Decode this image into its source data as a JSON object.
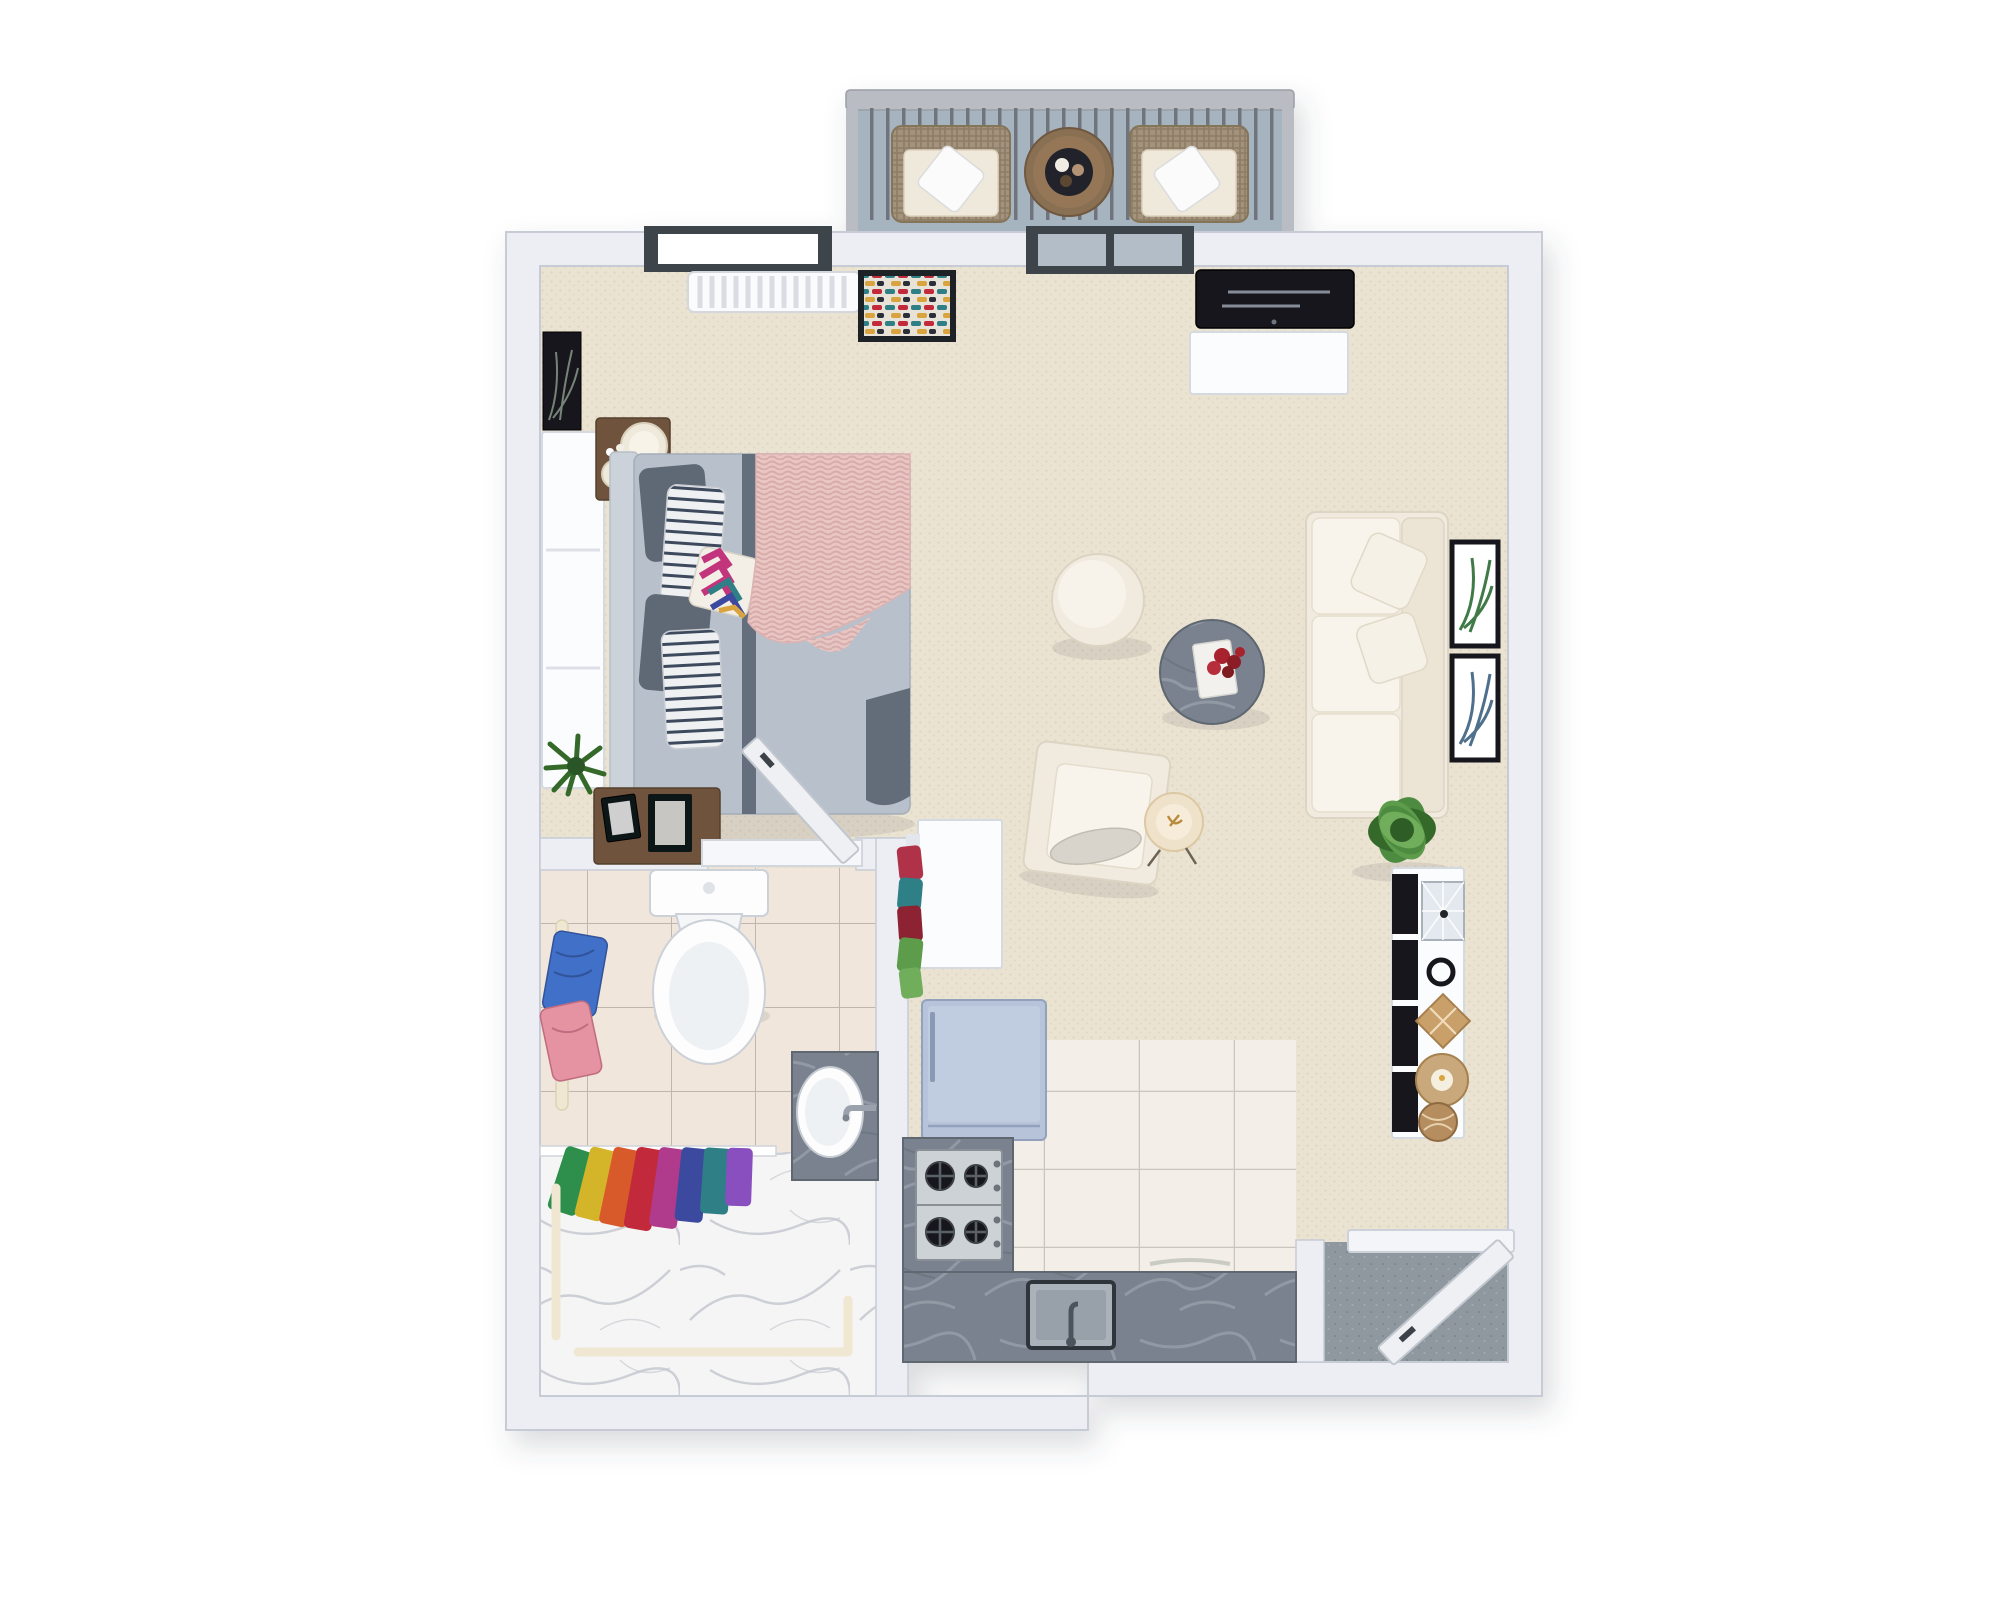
{
  "scene": {
    "title": "3D top-down floor plan of a studio apartment",
    "subtitle": "One-room apartment with balcony, open living/bedroom, bathroom and kitchen",
    "view": "axonometric top-down 3D render on white background"
  },
  "palette": {
    "wall-fill": "#eceef4",
    "wall-edge": "#c7cbd5",
    "floor-carpet": "#ebe3d2",
    "carpet-dot": "#ded3bd",
    "bath-tile": "#f0e6dc",
    "tile-grout": "#97908a",
    "kitchen-tile": "#f3efe8",
    "kitchen-grout": "#c6c1b8",
    "marble-counter": "#79828e",
    "marble-vein": "#a3abb5",
    "shower-marble": "#f6f5f5",
    "shower-vein": "#c2c5cd",
    "entry-stone": "#8f989f",
    "balcony-floor": "#a6b4c0",
    "rail-metal": "#b9bcc2",
    "baluster": "#6f757d",
    "wicker": "#a4937c",
    "cushion": "#efe9dc",
    "pillow-white": "#fbfbfb",
    "wood": "#6f523c",
    "wood-dark": "#54402e",
    "sofa-cream": "#f1ebdf",
    "bed-duvet": "#b8c1cb",
    "bed-trim": "#5c6573",
    "pillow-dark": "#5f6875",
    "blanket-pink": "#e9c6c2",
    "tv-black": "#16191e",
    "door-frame": "#3e444c",
    "glass": "#b2bdc8",
    "fridge": "#b6c3d8",
    "steel": "#cdd2d6",
    "plant-green": "#4e8c3f",
    "plant-dark": "#36692c",
    "towel-blue": "#4070c8",
    "towel-pink": "#e592a2",
    "accent-red": "#c22a3a",
    "accent-teal": "#2e7f86",
    "accent-yellow": "#d9a43c",
    "accent-navy": "#3b4a9f",
    "accent-magenta": "#c2347c"
  },
  "rooms": [
    {
      "id": "balcony",
      "label": "Balcony",
      "furniture": [
        "metal railing",
        "wicker armchair with white pillow",
        "wicker armchair with white pillow",
        "round wood side table",
        "black serving tray with cups"
      ]
    },
    {
      "id": "bedroom",
      "label": "Bedroom area",
      "furniture": [
        "double bed with grey duvet",
        "pink chunky-knit throw",
        "chevron accent pillow",
        "striped pillows",
        "wood nightstand with decorative plate and vase",
        "white radiator",
        "skylight window",
        "colourful weave wall art",
        "black palm print",
        "white wardrobe",
        "wood dresser with photo frames",
        "potted palm plant"
      ]
    },
    {
      "id": "living-room",
      "label": "Living room",
      "furniture": [
        "wall-mounted TV",
        "white media console",
        "sliding balcony door",
        "cream three-seat sofa",
        "two palm leaf wall prints",
        "round cream pouf",
        "round marble coffee table with book and red flowers",
        "cream armchair with bolster",
        "floor lamp",
        "green potted plant",
        "white console table with black fronts",
        "glass terrarium",
        "decor ring, basket, candle tray and woven ball"
      ]
    },
    {
      "id": "bathroom",
      "label": "Bathroom",
      "furniture": [
        "toilet",
        "towel rail with blue and pink towels",
        "marble vanity with oval sink",
        "walk-in marble shower",
        "rainbow towel set on glass panel",
        "cream grab bars",
        "inward-swinging door"
      ]
    },
    {
      "id": "kitchen",
      "label": "Kitchen",
      "furniture": [
        "light-blue refrigerator",
        "tall white cabinet",
        "open clothes rack with garments",
        "grey marble L-counter",
        "four-burner gas cooktop",
        "dark-rim kitchen sink with faucet"
      ]
    },
    {
      "id": "entry",
      "label": "Entry",
      "furniture": [
        "entry door swinging inward",
        "white threshold",
        "grey stone floor"
      ]
    }
  ]
}
